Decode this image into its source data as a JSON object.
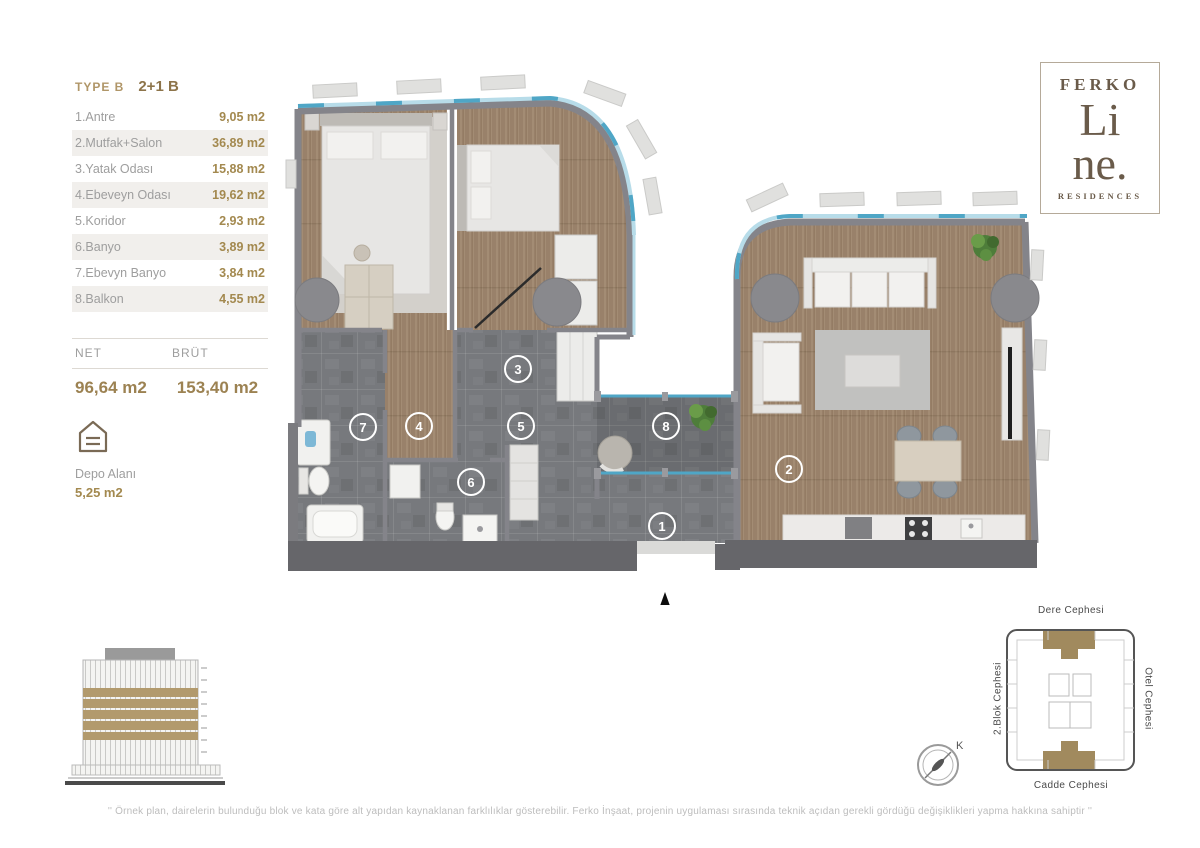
{
  "unit": {
    "type_label": "TYPE B",
    "variant_label": "2+1 B",
    "rooms": [
      {
        "name": "1.Antre",
        "area": "9,05 m2"
      },
      {
        "name": "2.Mutfak+Salon",
        "area": "36,89 m2"
      },
      {
        "name": "3.Yatak Odası",
        "area": "15,88 m2"
      },
      {
        "name": "4.Ebeveyn Odası",
        "area": "19,62 m2"
      },
      {
        "name": "5.Koridor",
        "area": "2,93 m2"
      },
      {
        "name": "6.Banyo",
        "area": "3,89 m2"
      },
      {
        "name": "7.Ebevyn Banyo",
        "area": "3,84 m2"
      },
      {
        "name": "8.Balkon",
        "area": "4,55 m2"
      }
    ],
    "net_label": "NET",
    "brut_label": "BRÜT",
    "net_value": "96,64 m2",
    "brut_value": "153,40 m2",
    "storage_label": "Depo Alanı",
    "storage_value": "5,25 m2"
  },
  "logo": {
    "brand": "FERKO",
    "name_line1": "Li",
    "name_line2": "ne.",
    "subtitle": "RESIDENCES"
  },
  "plan": {
    "room_numbers": [
      "1",
      "2",
      "3",
      "4",
      "5",
      "6",
      "7",
      "8"
    ]
  },
  "compass": {
    "north_label": "K"
  },
  "site_plan": {
    "top_label": "Dere Cephesi",
    "bottom_label": "Cadde Cephesi",
    "left_label": "2.Blok Cephesi",
    "right_label": "Otel Cephesi"
  },
  "footer": {
    "disclaimer": "'' Örnek plan, dairelerin bulunduğu blok ve kata göre alt yapıdan kaynaklanan farklılıklar gösterebilir. Ferko İnşaat, projenin uygulaması sırasında teknik açıdan gerekli gördüğü değişiklikleri yapma hakkına sahiptir ''"
  },
  "colors": {
    "gold": "#a3894f",
    "brown": "#6a5b4a",
    "gray_text": "#9e9e9e",
    "wood": "#a38c74",
    "stone": "#77797d",
    "wall": "#84848a",
    "glass_blue": "#4fa6c6"
  }
}
